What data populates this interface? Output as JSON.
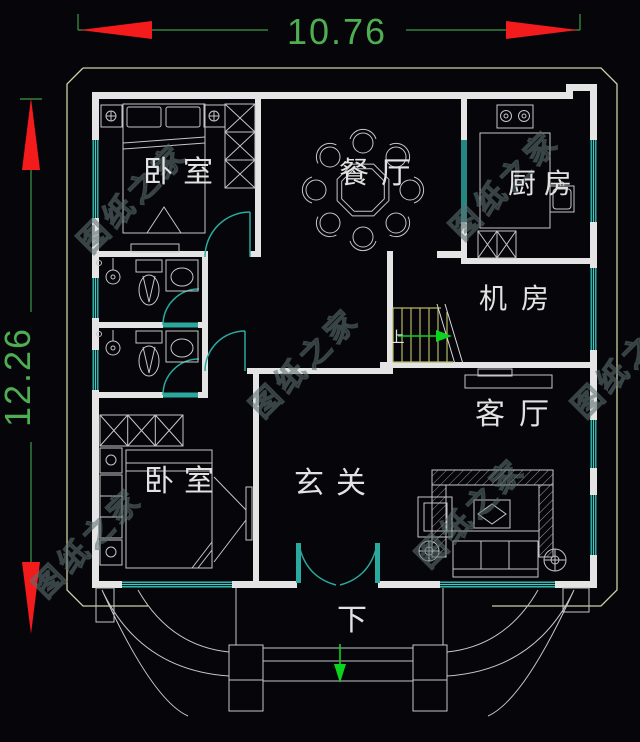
{
  "plan": {
    "dimensions": {
      "width_label": "10.76",
      "height_label": "12.26"
    },
    "rooms": [
      {
        "id": "bedroom-top",
        "label": "卧室"
      },
      {
        "id": "dining-room",
        "label": "餐厅"
      },
      {
        "id": "kitchen",
        "label": "厨房"
      },
      {
        "id": "machine-room",
        "label": "机房"
      },
      {
        "id": "living-room",
        "label": "客厅"
      },
      {
        "id": "entry-hall",
        "label": "玄关"
      },
      {
        "id": "bedroom-bottom",
        "label": "卧室"
      }
    ],
    "stair_direction_label": "上",
    "entry_direction_label": "下",
    "watermark_text": "图纸之家",
    "colors": {
      "background": "#05050a",
      "wall": "#e4e4e4",
      "furniture": "#c6c6c6",
      "window": "#38cdc2",
      "door": "#2aa99e",
      "stair": "#b8b863",
      "offset_outline": "#cfcfa6",
      "dimension_text": "#4fae52",
      "dimension_line": "#3f9a45",
      "arrow_red": "#f31b1b",
      "arrow_green": "#0ad41e",
      "watermark": "#5d6e6e"
    }
  }
}
